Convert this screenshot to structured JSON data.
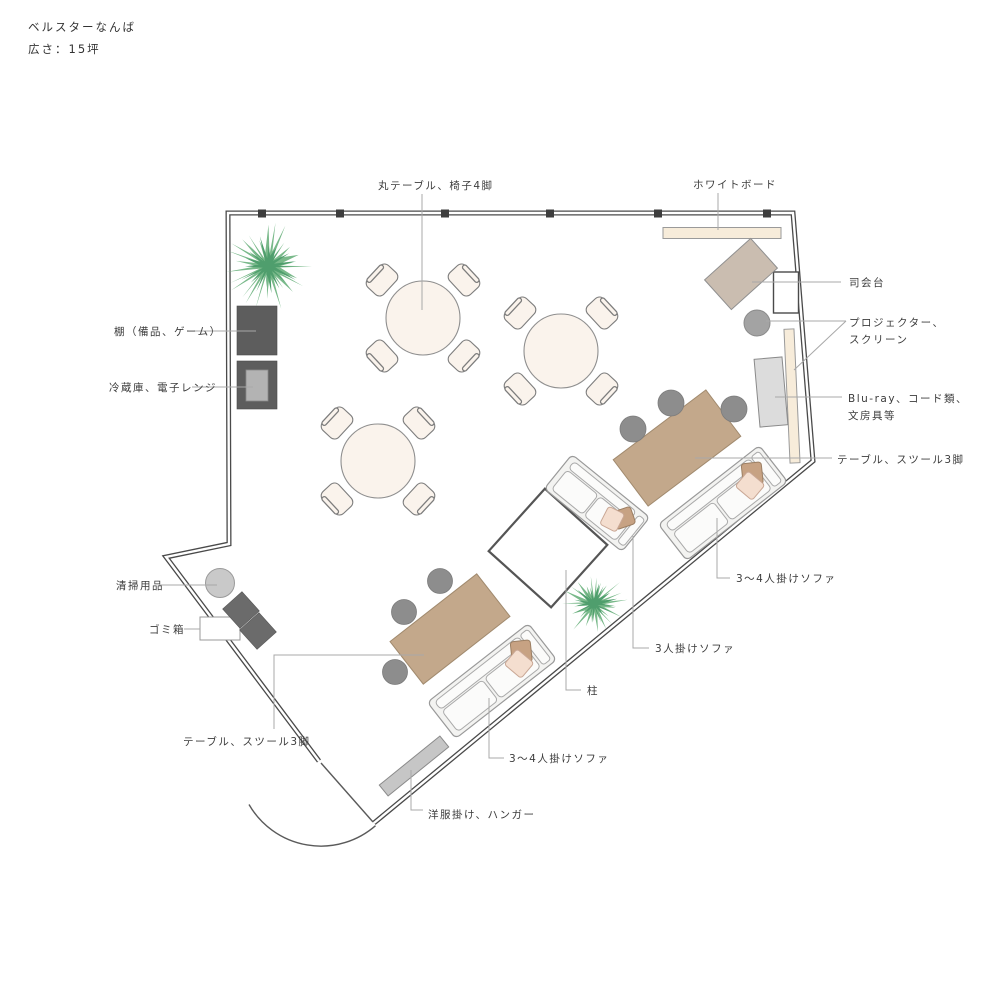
{
  "title": {
    "name": "ベルスターなんば",
    "size": "広さ：15坪"
  },
  "labels": {
    "round_table": "丸テーブル、椅子4脚",
    "whiteboard": "ホワイトボード",
    "mc_stand": "司会台",
    "projector_1": "プロジェクター、",
    "projector_2": "スクリーン",
    "bluray_1": "Blu-ray、コード類、",
    "bluray_2": "文房具等",
    "table_stools_right": "テーブル、スツール3脚",
    "sofa_34_right": "3〜4人掛けソファ",
    "sofa_3": "3人掛けソファ",
    "pillar": "柱",
    "cleaning": "清掃用品",
    "trash": "ゴミ箱",
    "shelf": "棚（備品、ゲーム）",
    "fridge": "冷蔵庫、電子レンジ",
    "table_stools_bottom": "テーブル、スツール3脚",
    "sofa_34_bottom": "3〜4人掛けソファ",
    "rack": "洋服掛け、ハンガー"
  },
  "colors": {
    "wall": "#4a4a4a",
    "wood": "#c3a88b",
    "cream": "#f7ecda",
    "table_top": "#faf3ec",
    "green_light": "#79b98a",
    "green_dark": "#4f9e6d",
    "gray_dark": "#5d5d5d",
    "stool": "#8d8d8d",
    "pink": "#f4decf",
    "tan": "#c7a283"
  }
}
